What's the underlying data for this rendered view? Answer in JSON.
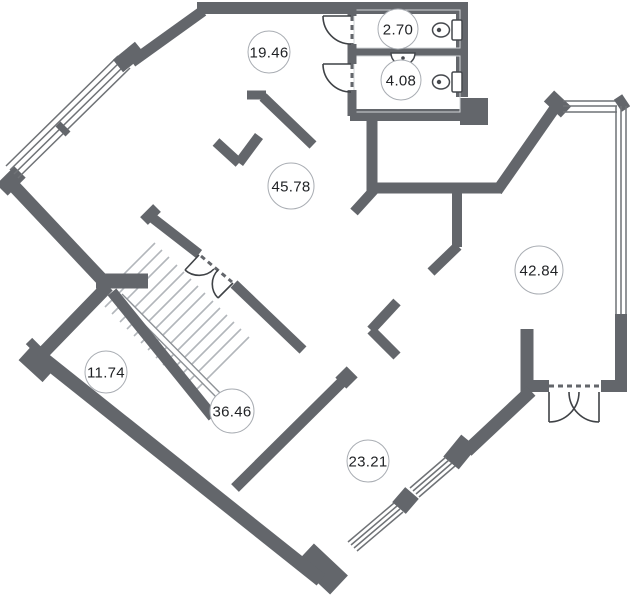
{
  "plan": {
    "type": "floor-plan",
    "rooms": [
      {
        "label": "19.46",
        "cx": 269,
        "cy": 52,
        "r": 21
      },
      {
        "label": "2.70",
        "cx": 398,
        "cy": 29,
        "r": 20
      },
      {
        "label": "4.08",
        "cx": 401,
        "cy": 80,
        "r": 20
      },
      {
        "label": "45.78",
        "cx": 291,
        "cy": 186,
        "r": 23
      },
      {
        "label": "42.84",
        "cx": 539,
        "cy": 270,
        "r": 24
      },
      {
        "label": "11.74",
        "cx": 106,
        "cy": 372,
        "r": 21
      },
      {
        "label": "36.46",
        "cx": 232,
        "cy": 411,
        "r": 22
      },
      {
        "label": "23.21",
        "cx": 368,
        "cy": 461,
        "r": 21
      }
    ],
    "fixtures": [
      "toilet-icon",
      "toilet-icon",
      "sink-icon",
      "stairs",
      "interior-door-arc",
      "entrance-double-door",
      "window-band"
    ],
    "colors": {
      "background": "#ffffff",
      "wall": "#63666b",
      "window-line": "#6f7276",
      "light-line": "#d2d4d7",
      "tread": "#b2b6bb",
      "stringer": "#8d9196",
      "door-line": "#3f4246",
      "fixture-line": "#45484d",
      "label-text": "#1f2124",
      "label-border": "#a9adb3",
      "label-fill": "#ffffff"
    }
  }
}
